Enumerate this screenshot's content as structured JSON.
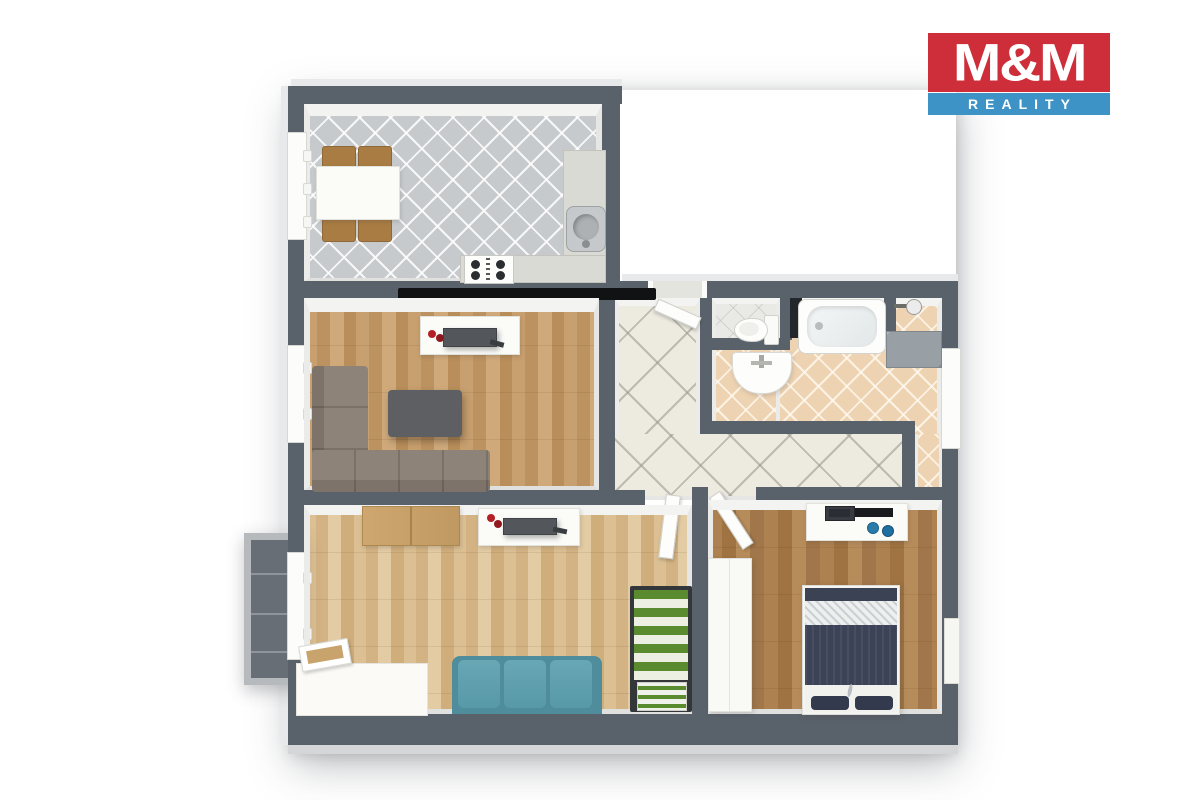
{
  "logo": {
    "line1": "M&M",
    "line2": "REALITY",
    "red": "#cd2e39",
    "blue": "#3d92c6",
    "text_color": "#ffffff"
  },
  "palette": {
    "background": "#ffffff",
    "wall": "#59616b",
    "kitchen_tile": "#c7cacd",
    "hallway_tile": "#edeae0",
    "bathroom_tile": "#eed3b2",
    "wc_tile": "#e9e9e6",
    "living_room_wood": "#c89f6e",
    "second_room_wood": "#dcc094",
    "bedroom_wood": "#ad8150",
    "balcony_floor": "#676e75",
    "corner_sofa": "#8e8378",
    "teal_sofa": "#5f9fae",
    "coffee_table": "#5d5f63",
    "chair_wood": "#a87c42",
    "counter": "#dadad4",
    "bed_navy": "#3c4357",
    "single_bed_green": "#5a8b2f",
    "decor_red": "#b32026",
    "tv_black": "#111214"
  }
}
